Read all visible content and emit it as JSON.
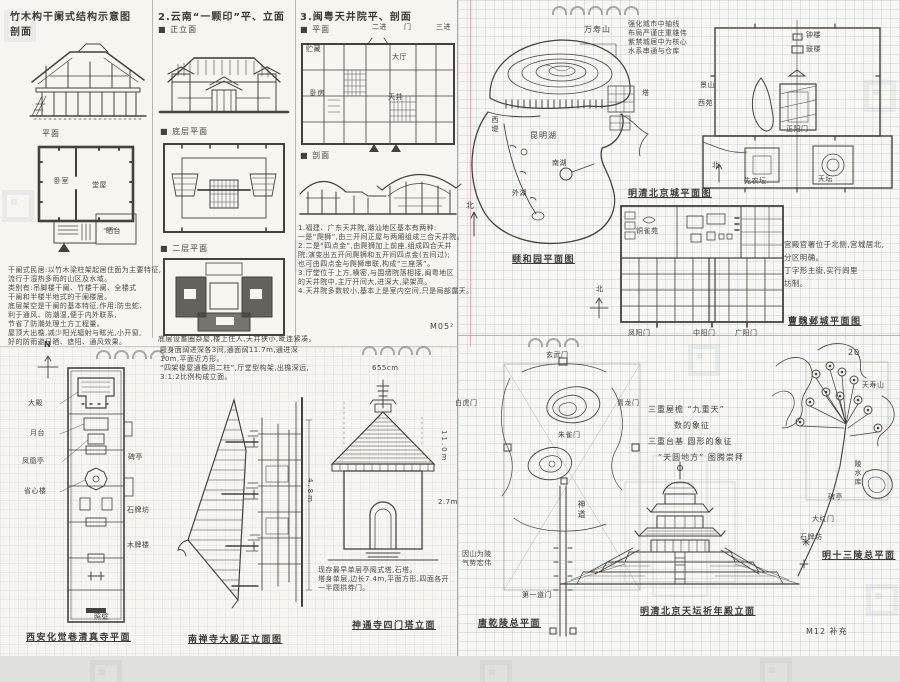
{
  "panel_a": {
    "col1": {
      "title": "竹木构干阑式结构示意图",
      "subtitle": "剖面",
      "plan_label": "平面",
      "room_labels": {
        "bedroom": "卧室",
        "hall": "堂屋",
        "terrace": "晒台"
      },
      "notes": [
        "干阑式民居:以竹木梁柱架起居住面为主要特征,",
        "流行于湿热多雨的山区及水域。",
        "类别有:吊脚楼干阑、竹楼干阑、全楼式",
        "干阑和半楼半地式的干阑楼居。",
        "底层架空是干阑的基本特征,作用:防虫蛇、",
        "利于通风、防潮湿,便于内外联系,",
        "节省了防潮处理土方工程量。",
        "屋顶大出檐,减少阳光辐射与眩光,小开窗,",
        "好的防雨避日晒、遮阳、通风效果。"
      ]
    },
    "col2": {
      "title": "2.云南“一颗印”平、立面",
      "elev_label": "■ 正立面",
      "plan1_label": "■ 底层平面",
      "plan2_label": "■ 二层平面",
      "note": "底层设畜圈杂屋,楼上住人,天井狭小,毗连紧凑。"
    },
    "col3": {
      "title": "3.闽粤天井院平、剖面",
      "plan_label": "■ 平面",
      "axis_labels": [
        "二进",
        "门",
        "三进"
      ],
      "room_labels": {
        "storage": "贮藏",
        "bedroom": "卧房",
        "hall": "大厅",
        "courtyard": "天井"
      },
      "section_label": "■ 剖面",
      "notes": [
        "1.福建、广东天井院,潮汕地区基本有两种:",
        "一是“爬狮”,由三开间正屋与两厢组成三合天井院。",
        "2.二是“四点金”,由爬狮加上前座,组成四合天井",
        "院,演变出五开间爬狮和五开间四点金(五间过);",
        "也可由四点金与爬狮串联,构成“三座落”。",
        "3.厅堂位于上方,横密,与围墙院落相接,闽粤地区",
        "的天井院中,主厅开间大,进深大,梁架高。",
        "4.天井院多数较小,基本上是室内空间,只是局部露天。"
      ],
      "page_mark": "M05²"
    }
  },
  "panel_b": {
    "summer_palace": {
      "labels": {
        "hill": "万寿山",
        "pagoda": "塔",
        "lake": "昆明湖",
        "dike": "西堤",
        "south_lake": "南湖",
        "outer_lake": "外湖",
        "north": "北"
      },
      "caption": "颐和园平面图"
    },
    "beijing": {
      "notes": [
        "强化城市中轴线",
        "布局严谨庄重雄伟",
        "紫禁城居中为核心",
        "水系串通与仓库"
      ],
      "labels": {
        "bell": "钟楼",
        "drum": "鼓楼",
        "jingshan": "景山",
        "xiyuan": "西苑",
        "gate": "正阳门",
        "tiantan": "天坛",
        "xiannongtan": "先农坛",
        "north": "北"
      },
      "caption": "明清北京城平面图"
    },
    "yecheng": {
      "garden_label": "铜雀苑",
      "gates": [
        "凤阳门",
        "中阳门",
        "广阳门"
      ],
      "north": "北",
      "notes": [
        "宫殿官署位于北侧,宫城居北,",
        "分区明确。",
        "丁字形主街,实行闾里",
        "坊制。"
      ],
      "caption": "曹魏邺城平面图"
    }
  },
  "panel_c": {
    "mosque": {
      "north": "N",
      "labels_left": [
        "大殿",
        "月台",
        "凤凰亭",
        "省心楼"
      ],
      "labels_right": [
        "碑亭"
      ],
      "labels_mid": [
        "石牌坊",
        "木牌楼"
      ],
      "label_bottom": "照壁",
      "caption": "西安化觉巷清真寺平面"
    },
    "nanchansi": {
      "notes": [
        "殿身面阔进深各3间,通面阔11.7m,通进深",
        "10m,平面近方形。",
        "“四架椽屋通檐用二柱”,厅堂型构架,出檐深远,",
        "3:1:2比例构成立面。"
      ],
      "dim": "4.8m",
      "caption": "南禅寺大殿正立面图"
    },
    "simenta": {
      "dim_top": "655cm",
      "dim_right1": "11.0m",
      "dim_right2": "2.7m",
      "notes": [
        "现存最早单层亭阁式塔,石塔。",
        "塔身单层,边长7.4m,平面方形,四面各开",
        "一半圆拱券门。"
      ],
      "caption": "神通寺四门塔立面"
    }
  },
  "panel_d": {
    "qianling": {
      "labels": {
        "north_gate": "玄武门",
        "east_gate": "青龙门",
        "west_gate": "白虎门",
        "south_gate": "朱雀门",
        "spirit_way": "神道",
        "first_gate": "第一道门"
      },
      "side_note": [
        "因山为陵",
        "气势宏伟"
      ],
      "caption": "唐乾陵总平面"
    },
    "tiantan_notes": [
      "三重屋檐 “九重天”",
      "数的象征",
      "三重台基 圆形的象征",
      "“天圆地方” 图腾崇拜"
    ],
    "shisanling": {
      "page_num": "20",
      "labels": {
        "mountain": "天寿山",
        "reservoir": "陵水库",
        "stele": "碑亭",
        "gate": "大红门",
        "archway": "石牌坊"
      },
      "caption": "明十三陵总平面"
    },
    "qinian_caption": "明清北京天坛祈年殿立面",
    "corner_mark": "M12 补充"
  }
}
